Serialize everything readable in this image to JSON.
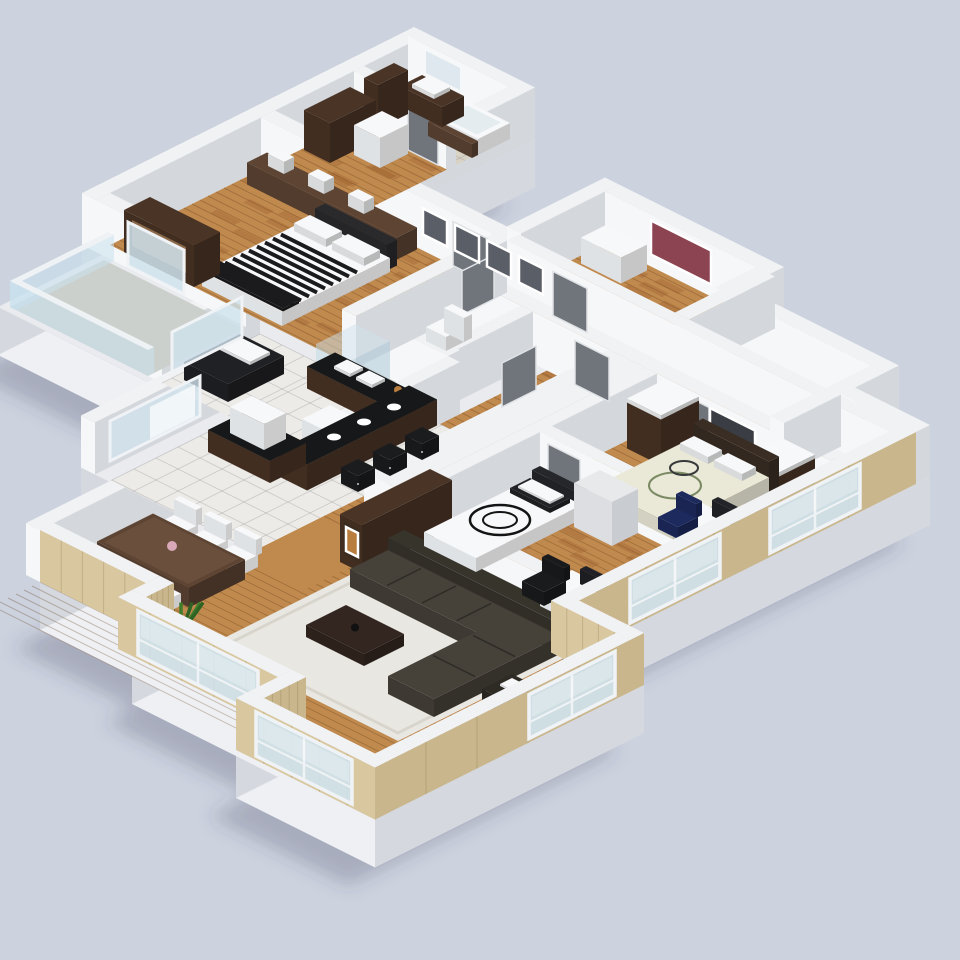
{
  "scene": {
    "type": "3d-isometric-floor-plan",
    "description": "3D rendered apartment floor plan, isometric top view",
    "view": "isometric"
  },
  "palette": {
    "bg": "#ccd2de",
    "shadow": "rgba(55,65,90,0.25)",
    "slab_top": "#e9ebee",
    "slab_sw": "#eef0f3",
    "slab_se": "#d5d9df",
    "wall_top": "#f1f2f4",
    "wall_sw": "#f6f7f8",
    "wall_se": "#d4d7db",
    "wall_tan_sw": "#d9c79f",
    "wall_tan_se": "#c9b68c",
    "wall_grain": "rgba(120,95,50,0.22)",
    "floor_wood": "#c08a4f",
    "floor_wood_line": "rgba(95,52,15,0.30)",
    "floor_tile": "#edebe7",
    "floor_tile_line": "rgba(120,120,125,0.28)",
    "floor_bath": "#d9d3c6",
    "floor_gray": "#b9bdc4",
    "balcony_floor": "#ccd0cc",
    "glass": "#cfe2ec",
    "glass_frame": "#f0f3f6",
    "rail_glass": "rgba(200,226,239,0.55)",
    "door": "#70747b",
    "dark_brown": "#4a3426",
    "mid_brown": "#5d4433",
    "counter_black": "#17181a",
    "white": "#f7f8f9",
    "white_shade": "#dfe2e5",
    "sofa": "#46423a",
    "sofa_dark": "#37342c",
    "rug": "#e9e7e1",
    "rug_border": "#d8d5cd",
    "bed_dark": "#1b1b1d",
    "cream": "#eae8d6",
    "navy": "#1d2a5e",
    "green_dark": "#2f6323",
    "green": "#3f7d2c",
    "amber": "#b97e3e",
    "pink": "#d8a8b8",
    "mirror": "#dfe8ee"
  },
  "rooms": [
    {
      "id": "bathroom-main",
      "floor": "beige-tile"
    },
    {
      "id": "laundry-hall",
      "floor": "wood"
    },
    {
      "id": "master-bedroom",
      "floor": "wood"
    },
    {
      "id": "study-room",
      "floor": "wood"
    },
    {
      "id": "storage-room-a",
      "floor": "gray"
    },
    {
      "id": "storage-room-b",
      "floor": "gray"
    },
    {
      "id": "hallway",
      "floor": "wood"
    },
    {
      "id": "wc",
      "floor": "beige-tile"
    },
    {
      "id": "bathroom-2",
      "floor": "beige-tile"
    },
    {
      "id": "corridor",
      "floor": "wood"
    },
    {
      "id": "bedroom-2",
      "floor": "wood"
    },
    {
      "id": "bedroom-3",
      "floor": "wood"
    },
    {
      "id": "kitchen",
      "floor": "white-tile"
    },
    {
      "id": "dining-area",
      "floor": "wood"
    },
    {
      "id": "living-room",
      "floor": "wood"
    },
    {
      "id": "balcony",
      "floor": "concrete"
    }
  ],
  "furniture": [
    "bathtub",
    "vanity-sink",
    "mirror",
    "washer",
    "laundry-cabinet",
    "striped-bed",
    "headboard-shelf",
    "wall-frames",
    "media-cabinet",
    "dresser",
    "wall-picture",
    "double-bed-cream",
    "wardrobes",
    "desk-with-monitor",
    "office-chair",
    "single-bed-swirl",
    "toilet",
    "shower-glass",
    "kitchen-counter",
    "kitchen-island",
    "breakfast-bar",
    "bar-stools",
    "dining-table",
    "dining-chairs",
    "sectional-sofa",
    "area-rug",
    "coffee-table",
    "side-table",
    "floor-lamp",
    "potted-plant",
    "bench"
  ],
  "openings": {
    "windows": 5,
    "glass_doors": 2,
    "doors": 7,
    "balcony_rails": 2
  }
}
